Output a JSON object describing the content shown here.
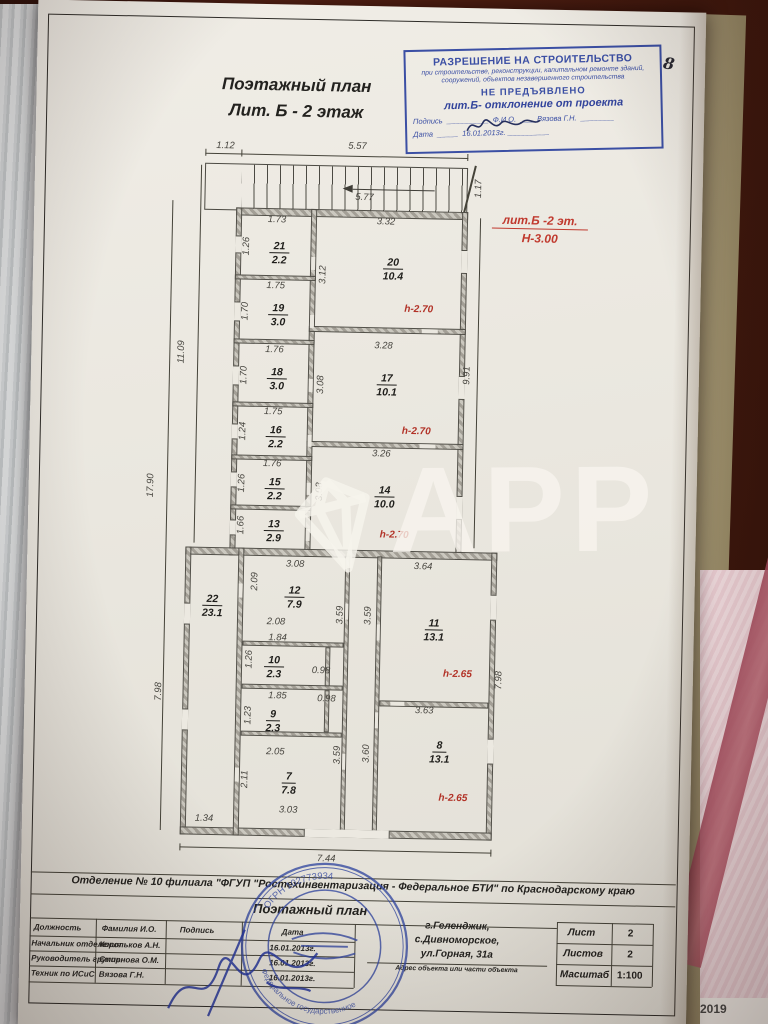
{
  "page_number": "8",
  "title": {
    "line1": "Поэтажный план",
    "line2": "Лит. Б - 2 этаж"
  },
  "stamp": {
    "title": "РАЗРЕШЕНИЕ НА СТРОИТЕЛЬСТВО",
    "subtitle": "при строительстве, реконструкции, капитальном ремонте зданий, сооружений, объектов незавершенного строительства",
    "status": "НЕ ПРЕДЪЯВЛЕНО",
    "note": "лит.Б- отклонение от проекта",
    "sign_label": "Подпись",
    "fio_label": "Ф.И.О.",
    "fio_value": "Вязова Г.Н.",
    "date_label": "Дата",
    "date_value": "16.01.2013г."
  },
  "plan_note": {
    "line1": "лит.Б -2 эт.",
    "line2": "Н-3.00"
  },
  "watermark": "APP",
  "dims": {
    "top1": "1.12",
    "top2": "5.57",
    "stair": "5.77",
    "top_right": "1.17",
    "left1": "11.09",
    "left2": "17.90",
    "left3": "7.98",
    "right1": "9.91",
    "right2": "7.98",
    "bottom_left": "1.34",
    "bottom": "7.44",
    "corr1": "3.59"
  },
  "rooms": {
    "r21": {
      "num": "21",
      "area": "2.2",
      "w": "1.73",
      "h": "1.26"
    },
    "r19": {
      "num": "19",
      "area": "3.0",
      "w": "1.75",
      "h": "1.70"
    },
    "r18": {
      "num": "18",
      "area": "3.0",
      "w": "1.76",
      "h": "1.70"
    },
    "r16": {
      "num": "16",
      "area": "2.2",
      "w": "1.75",
      "h": "1.24"
    },
    "r15": {
      "num": "15",
      "area": "2.2",
      "w": "1.76",
      "h": "1.26"
    },
    "r13": {
      "num": "13",
      "area": "2.9",
      "h": "1.66"
    },
    "r20": {
      "num": "20",
      "area": "10.4",
      "w": "3.32",
      "h": "3.12",
      "hh": "h-2.70"
    },
    "r17": {
      "num": "17",
      "area": "10.1",
      "w": "3.28",
      "h": "3.08",
      "hh": "h-2.70"
    },
    "r14": {
      "num": "14",
      "area": "10.0",
      "w": "3.26",
      "h": "3.08",
      "hh": "h-2.70"
    },
    "r22": {
      "num": "22",
      "area": "23.1"
    },
    "r12": {
      "num": "12",
      "area": "7.9",
      "w": "3.08",
      "h": "2.09"
    },
    "r10": {
      "num": "10",
      "area": "2.3",
      "w": "1.84",
      "w2": "2.08",
      "h": "1.26",
      "c": "0.98"
    },
    "r9": {
      "num": "9",
      "area": "2.3",
      "w": "1.85",
      "h": "1.23",
      "c": "0.98"
    },
    "r7": {
      "num": "7",
      "area": "7.8",
      "w": "2.05",
      "h": "2.11",
      "b": "3.03"
    },
    "r11": {
      "num": "11",
      "area": "13.1",
      "w": "3.64",
      "h": "3.59",
      "hh": "h-2.65"
    },
    "r8": {
      "num": "8",
      "area": "13.1",
      "w": "3.63",
      "h": "3.60",
      "h2": "3.59",
      "hh": "h-2.65"
    }
  },
  "tb": {
    "org": "Отделение № 10 филиала \"ФГУП \"Ростехинвентаризация - Федеральное БТИ\" по Краснодарскому краю",
    "doc_title": "Поэтажный план",
    "columns": [
      "Должность",
      "Фамилия И.О.",
      "Подпись",
      "Дата"
    ],
    "rows": [
      {
        "position": "Начальник отделения",
        "name": "Корольков А.Н.",
        "date": "16.01.2013г."
      },
      {
        "position": "Руководитель группы",
        "name": "Смирнова О.М.",
        "date": "16.01.2013г."
      },
      {
        "position": "Техник по ИСиС",
        "name": "Вязова Г.Н.",
        "date": "16.01.2013г."
      }
    ],
    "address": {
      "line1": "г.Геленджик,",
      "line2": "с.Дивноморское,",
      "line3": "ул.Горная, 31а",
      "caption": "Адрес объекта или части объекта"
    },
    "sheet_label": "Лист",
    "sheet_value": "2",
    "sheets_label": "Листов",
    "sheets_value": "2",
    "scale_label": "Масштаб",
    "scale_value": "1:100"
  },
  "round_stamp": {
    "arc_top": "ОГРН 102773934",
    "arc_bottom": "Федеральное государственное"
  },
  "side": {
    "year": "2019"
  }
}
